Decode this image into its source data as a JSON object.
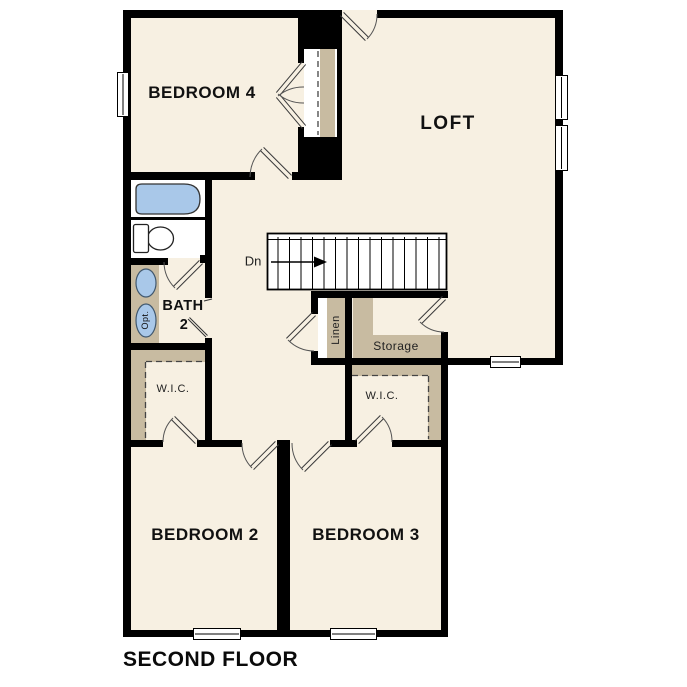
{
  "meta": {
    "plan_title": "SECOND FLOOR"
  },
  "rooms": {
    "bedroom4": {
      "label": "BEDROOM 4"
    },
    "loft": {
      "label": "LOFT"
    },
    "bath2": {
      "label_line1": "BATH",
      "label_line2": "2"
    },
    "wic_left": {
      "label": "W.I.C."
    },
    "wic_right": {
      "label": "W.I.C."
    },
    "linen": {
      "label": "Linen"
    },
    "storage": {
      "label": "Storage"
    },
    "bedroom2": {
      "label": "BEDROOM 2"
    },
    "bedroom3": {
      "label": "BEDROOM 3"
    }
  },
  "stairs": {
    "label": "Dn"
  },
  "fixtures": {
    "optional_label": "Opt."
  },
  "colors": {
    "walls": "#000000",
    "floor": "#f7f0e2",
    "closet_shelving_tan": "#c8bba1",
    "fixture_blue": "#a9c8e9",
    "background": "#ffffff",
    "text": "#111111"
  }
}
